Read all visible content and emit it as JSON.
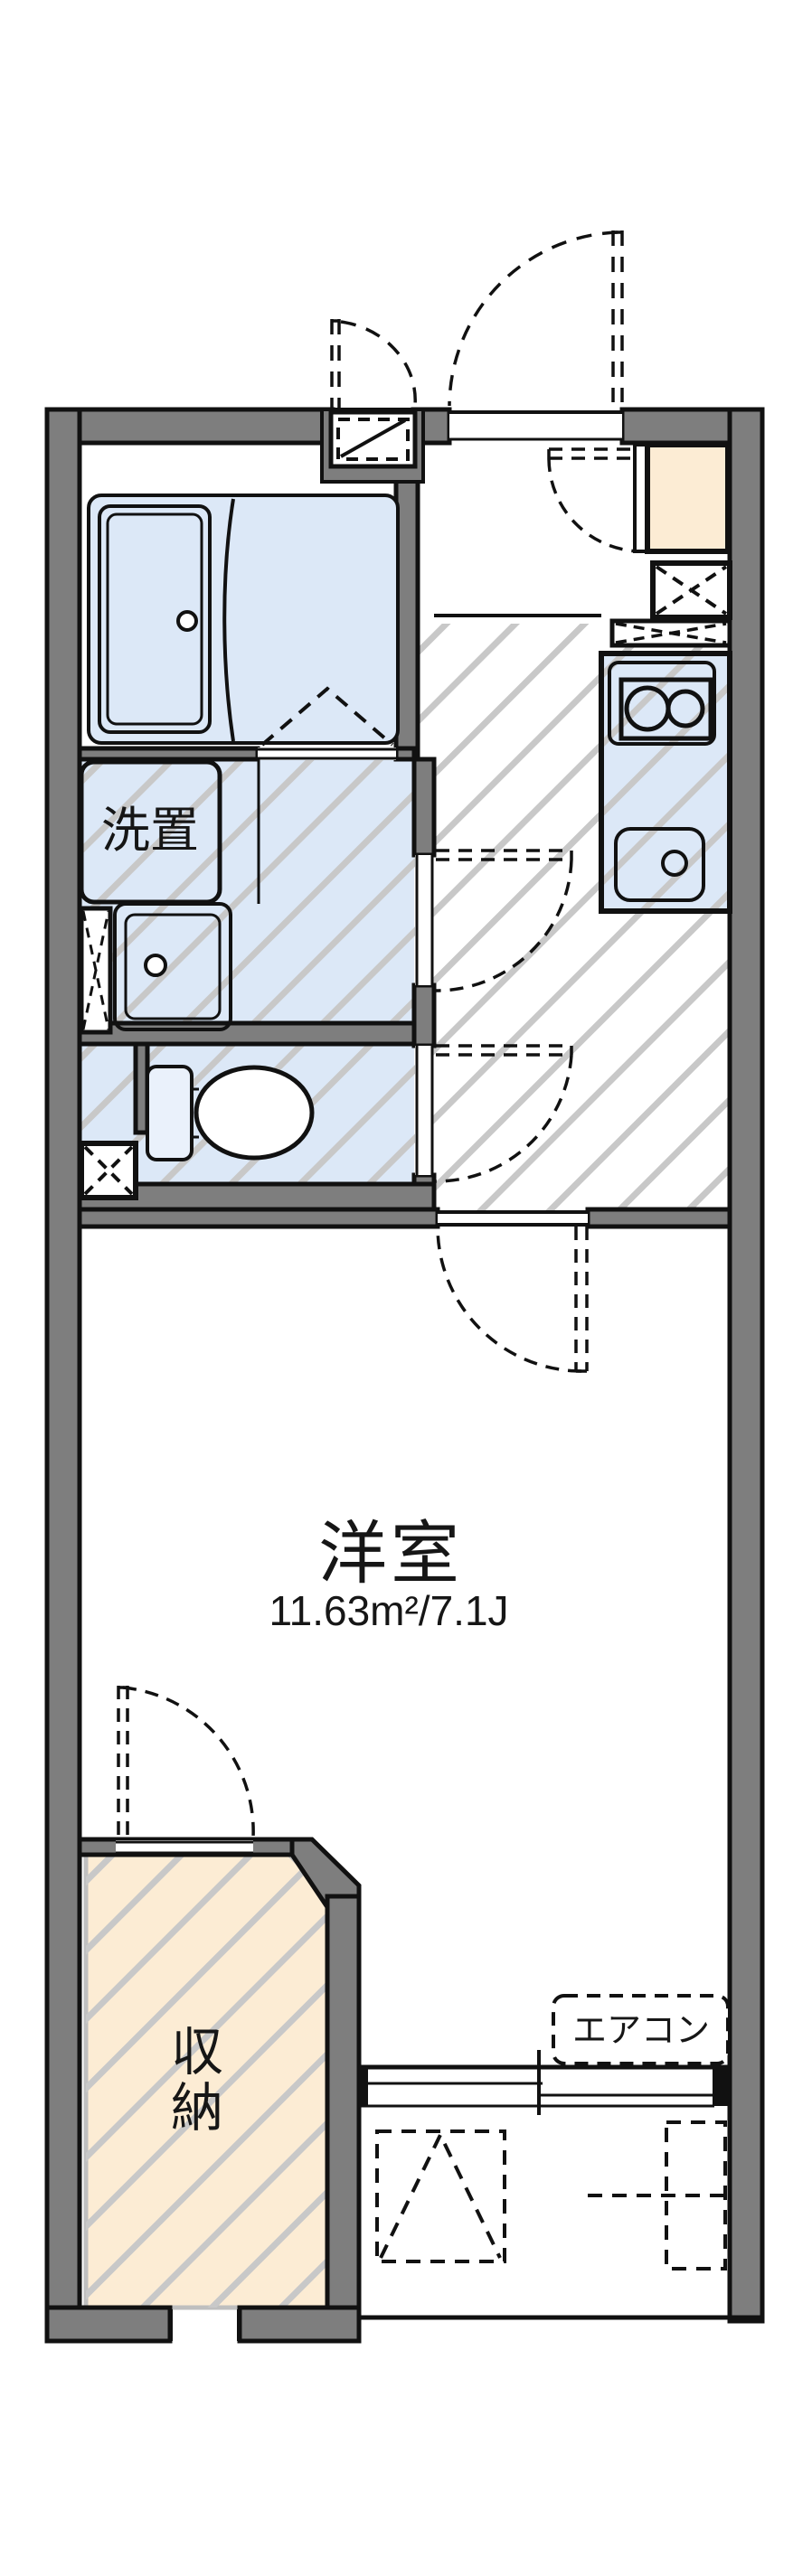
{
  "floorplan": {
    "type": "japanese-apartment-floorplan",
    "labels": {
      "washer_space": "洗置",
      "main_room": "洋室",
      "main_room_area": "11.63m²/7.1J",
      "closet": "収納",
      "closet_chars": [
        "収",
        "納"
      ],
      "aircon": "エアコン"
    },
    "colors": {
      "wall_gray": "#7e7e7e",
      "fixture_blue": "#dce8f7",
      "cabinet_cream": "#fcecd4",
      "hatch_gray": "#c8c8c8",
      "line_black": "#111111",
      "background": "#ffffff"
    }
  }
}
